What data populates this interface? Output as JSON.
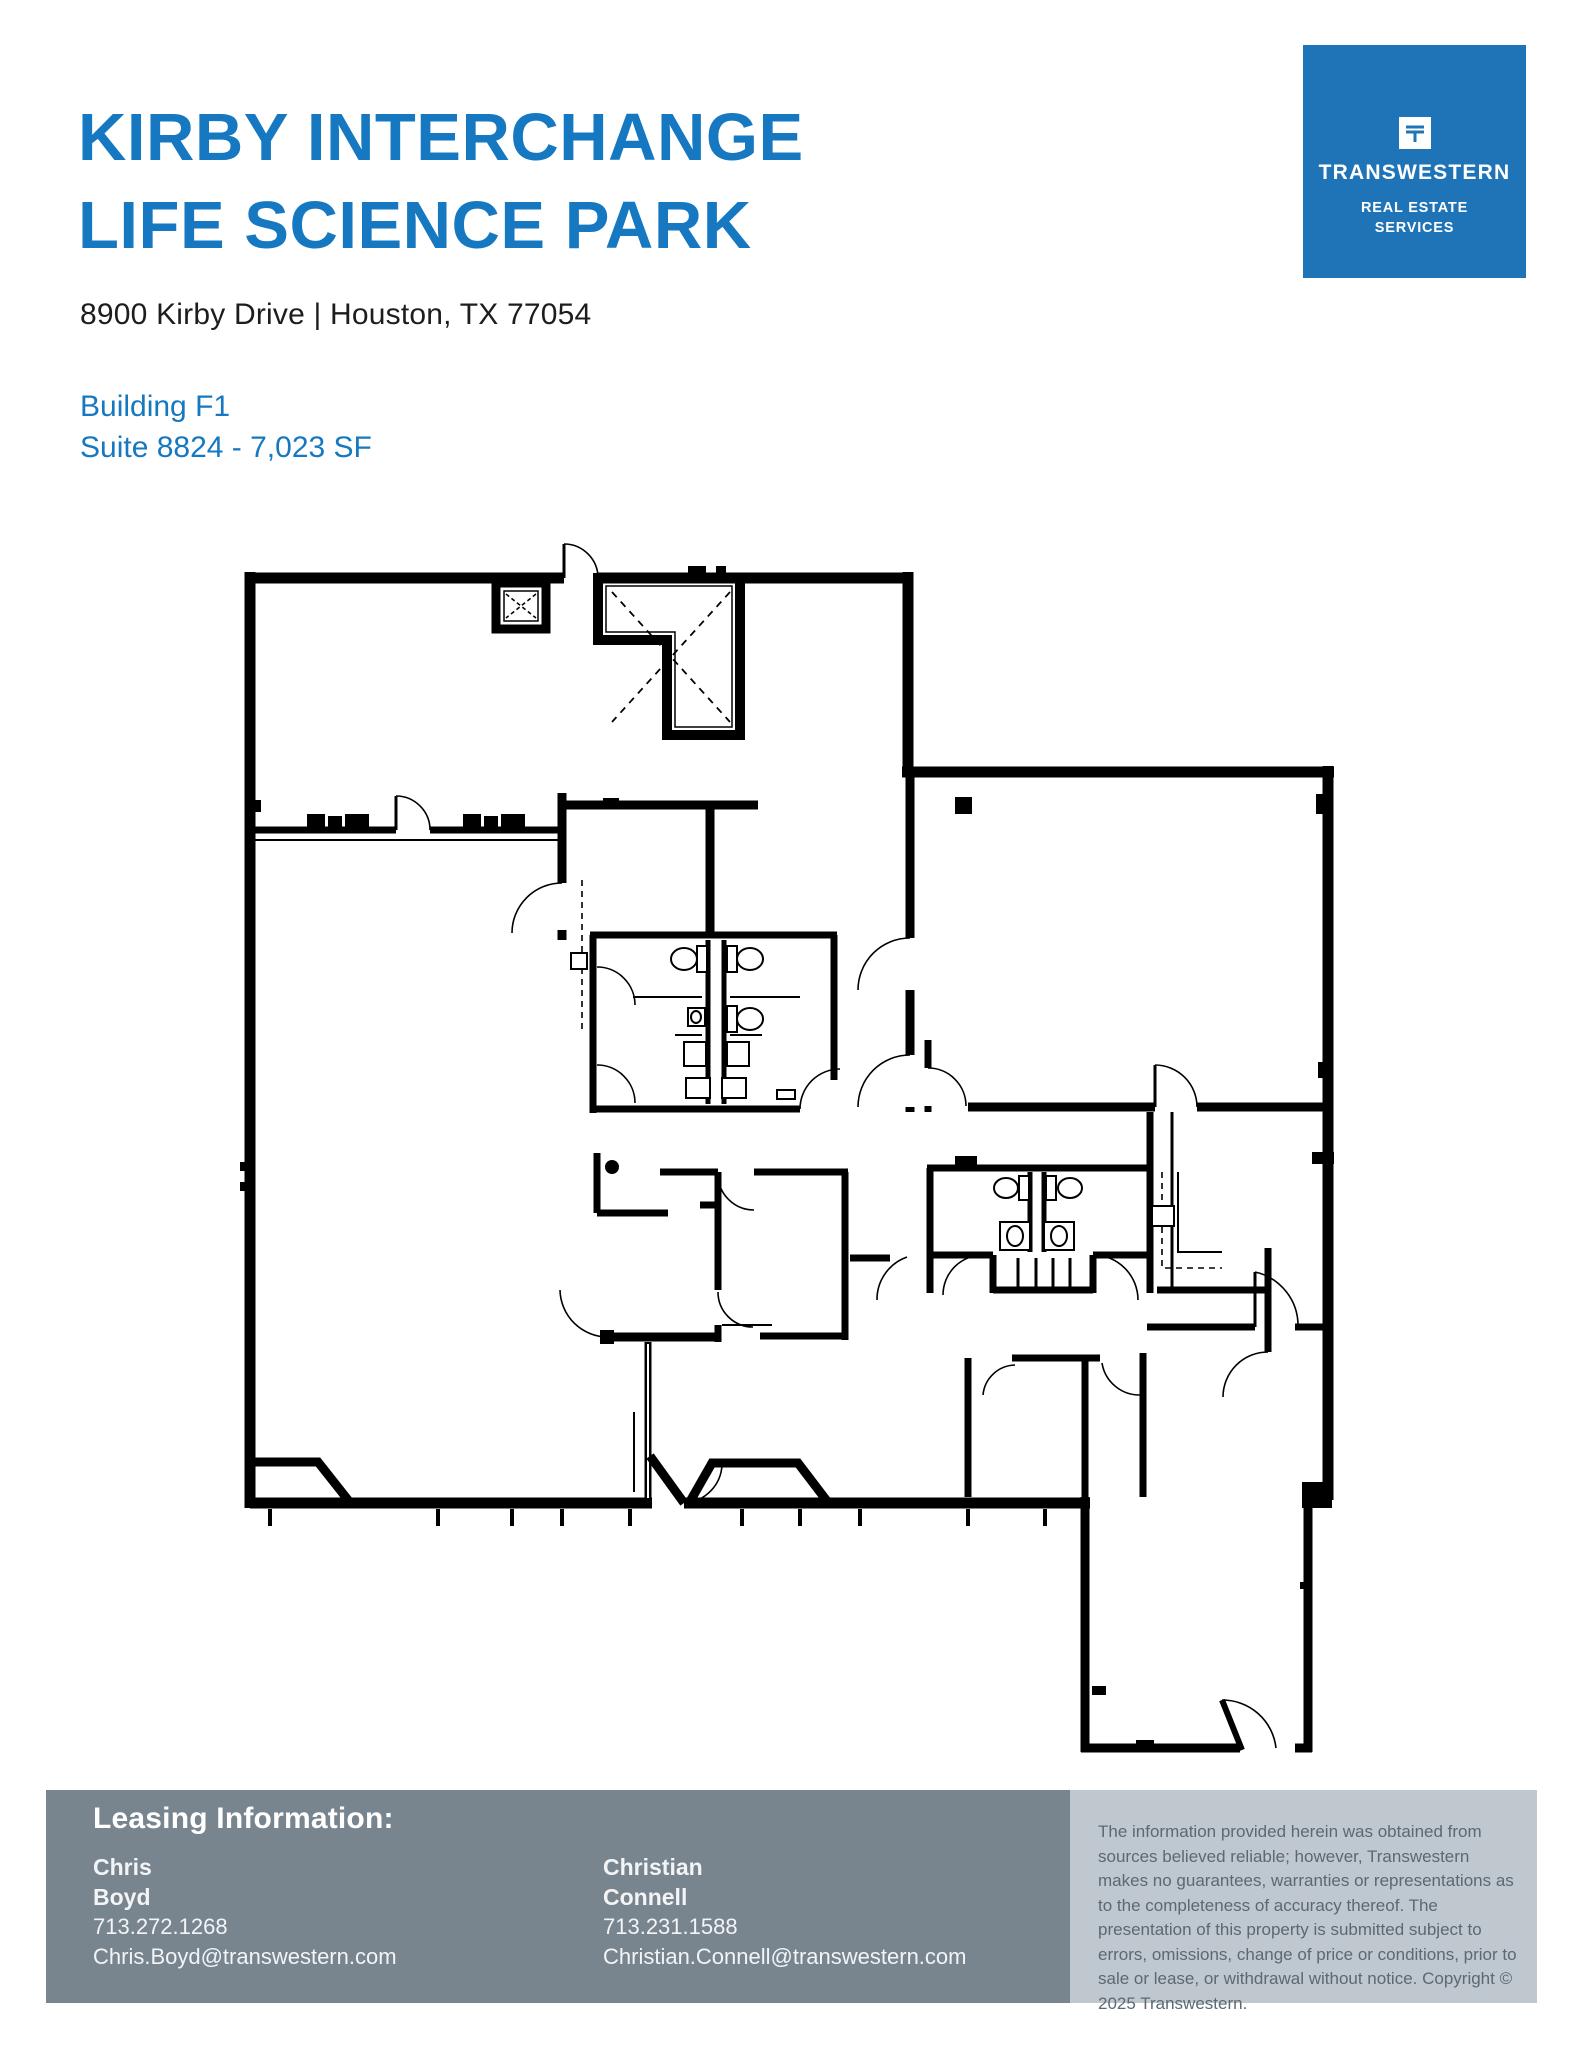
{
  "header": {
    "title_line1": "KIRBY INTERCHANGE",
    "title_line2": "LIFE SCIENCE PARK",
    "address": "8900 Kirby Drive | Houston, TX 77054",
    "building": "Building F1",
    "suite": "Suite 8824 - 7,023 SF"
  },
  "logo": {
    "wordmark": "TRANSWESTERN",
    "tagline_line1": "REAL ESTATE",
    "tagline_line2": "SERVICES"
  },
  "floor_plan": {
    "type": "architectural-floor-plan",
    "line_color": "#000000",
    "text_labels": []
  },
  "footer": {
    "heading": "Leasing Information:",
    "contacts": [
      {
        "first_name": "Chris",
        "last_name": "Boyd",
        "phone": "713.272.1268",
        "email": "Chris.Boyd@transwestern.com"
      },
      {
        "first_name": "Christian",
        "last_name": "Connell",
        "phone": "713.231.1588",
        "email": "Christian.Connell@transwestern.com"
      }
    ]
  },
  "disclaimer": {
    "text": "The information provided herein was obtained from sources believed reliable; however, Transwestern makes no guarantees, warranties or representations as to the completeness of accuracy thereof. The presentation of this property is submitted subject to errors, omissions, change of price or conditions, prior to sale or lease, or withdrawal without notice. Copyright © 2025 Transwestern."
  },
  "colors": {
    "brand_blue": "#1578c0",
    "logo_blue": "#1e74b6",
    "footer_gray": "#78858f",
    "panel_gray": "#bfc8cf",
    "disclaimer_ink": "#5d6872",
    "plan_line": "#000000"
  }
}
